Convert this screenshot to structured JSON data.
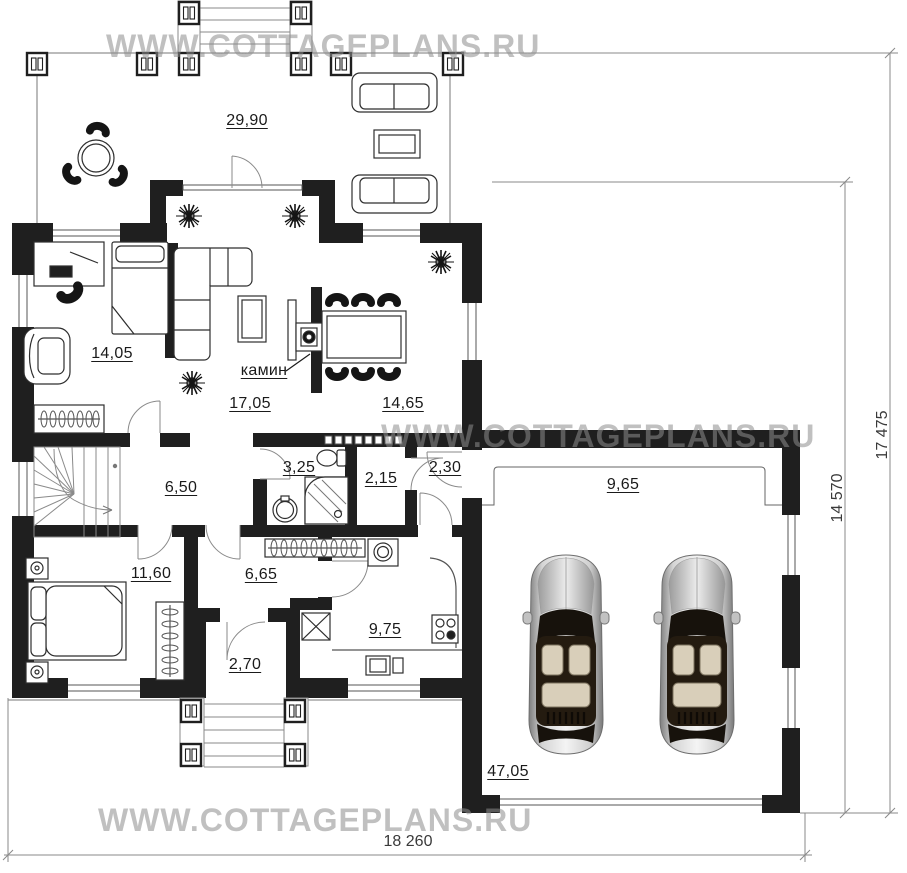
{
  "watermark": {
    "text": "WWW.COTTAGEPLANS.RU"
  },
  "room_areas": {
    "terrace": "29,90",
    "office": "14,05",
    "living_room": "17,05",
    "dining_room": "14,65",
    "stair_hall": "6,50",
    "bathroom": "3,25",
    "storage": "2,15",
    "mudroom": "2,30",
    "bedroom": "11,60",
    "hallway": "6,65",
    "kitchen": "9,75",
    "entrance_porch": "2,70",
    "garage_bay": "9,65",
    "garage": "47,05"
  },
  "annotations": {
    "fireplace": "камин"
  },
  "overall_dimensions": {
    "width_mm": "18 260",
    "height_right_outer_mm": "17 475",
    "height_right_inner_mm": "14 570"
  },
  "colors": {
    "wall": "#1f1f1f",
    "thin_line": "#666666",
    "dimension_line": "#8a8a8a",
    "watermark": "#c4c4c4",
    "label_text": "#1a1a1a"
  }
}
